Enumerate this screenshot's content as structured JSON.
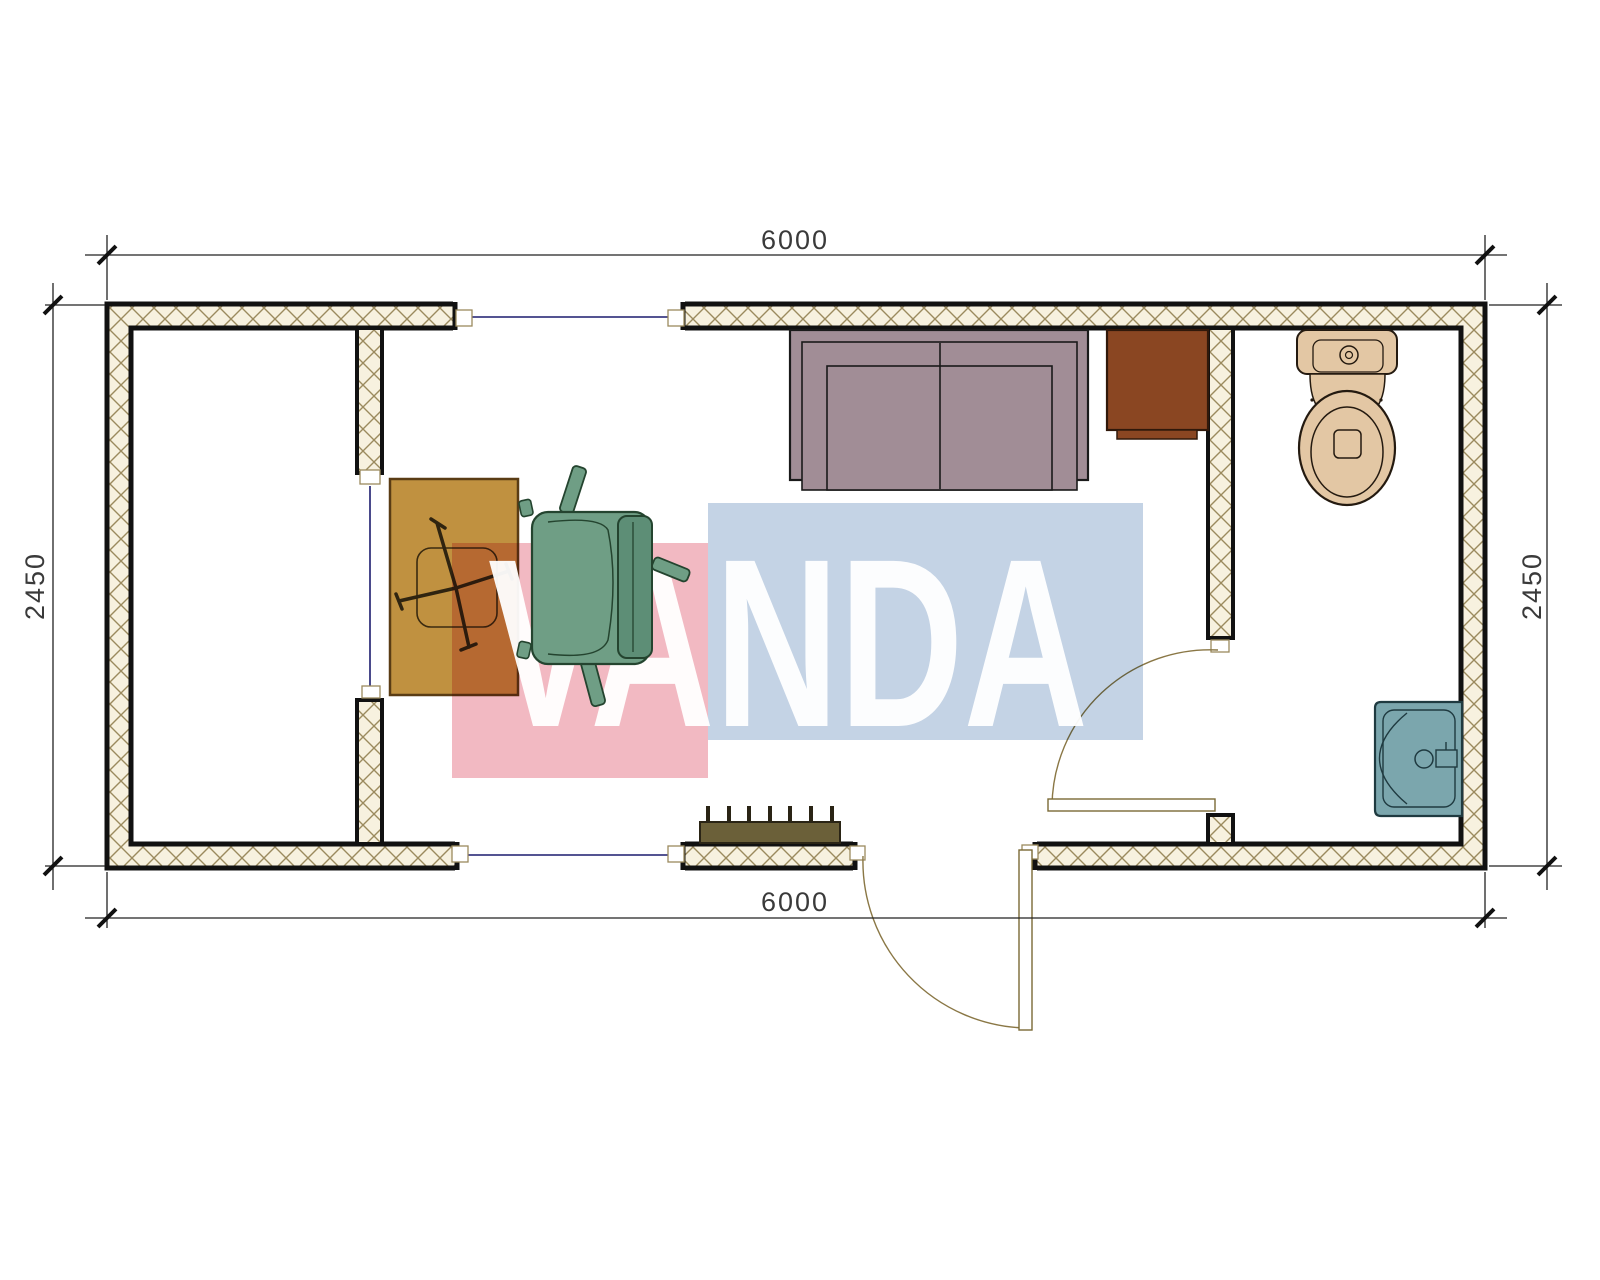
{
  "page": {
    "type": "architectural-floor-plan",
    "visible_title": ""
  },
  "dimensions": {
    "top_width": "6000",
    "bottom_width": "6000",
    "left_height": "2450",
    "right_height": "2450"
  },
  "watermark": {
    "text": "VANDA",
    "pink_block_color": "#f2b9c2",
    "blue_block_color": "#c4d3e5",
    "text_color": "#ffffff"
  },
  "colors": {
    "wall_hatch_bg": "#f7f1df",
    "wall_hatch_line": "#9b8a5e",
    "wall_outline": "#111111",
    "window_line": "#1c1c6e",
    "door_line": "#8a7745",
    "dimension_line": "#222222",
    "dimension_text": "#3a3a3a",
    "desk": "#c09140",
    "chair_seat": "#6f9e85",
    "chair_back": "#5d8e76",
    "sofa": "#a18d96",
    "side_table": "#8a4622",
    "toilet": "#e3c7a4",
    "sink": "#7ba6ad",
    "radiator": "#6b6039"
  },
  "furniture": [
    "desk",
    "office-chair",
    "sofa",
    "side-table",
    "toilet",
    "sink",
    "radiator"
  ],
  "openings": [
    "window-top",
    "window-bottom",
    "exterior-door",
    "interior-door",
    "partition-opening"
  ]
}
